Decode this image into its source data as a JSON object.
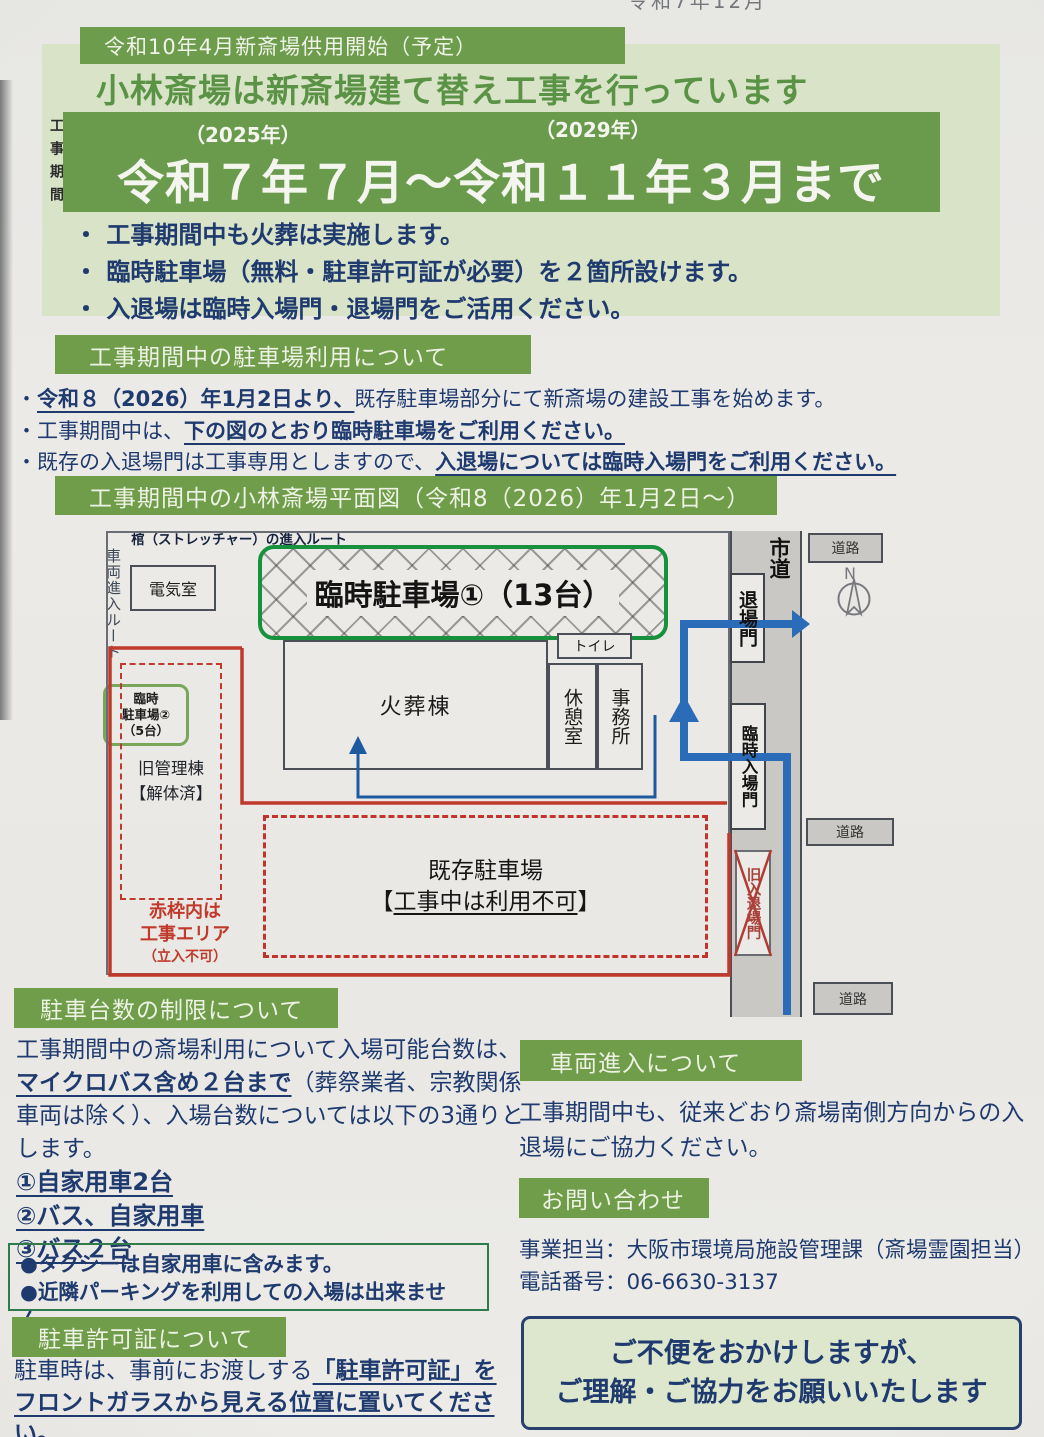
{
  "photo": {
    "top_cut_text": "令和7年12月"
  },
  "banner": {
    "pre_title": "令和10年4月新斎場供用開始（予定）",
    "title": "小林斎場は新斎場建て替え工事を行っています",
    "side_label": "工事期間",
    "year_start": "（2025年）",
    "year_end": "（2029年）",
    "period": "令和７年７月～令和１１年３月まで"
  },
  "intro_bullets": [
    "・ 工事期間中も火葬は実施します。",
    "・ 臨時駐車場（無料・駐車許可証が必要）を２箇所設けます。",
    "・ 入退場は臨時入場門・退場門をご活用ください。"
  ],
  "parking_use": {
    "heading": "工事期間中の駐車場利用について",
    "lines": [
      {
        "pre": "・",
        "bold": "令和８（2026）年1月2日より、",
        "rest": "既存駐車場部分にて新斎場の建設工事を始めます。"
      },
      {
        "pre": "・工事期間中は、",
        "bold": "下の図のとおり臨時駐車場をご利用ください。",
        "rest": ""
      },
      {
        "pre": "・既存の入退場門は工事専用としますので、",
        "bold": "入退場については臨時入場門をご利用ください。",
        "rest": ""
      }
    ]
  },
  "map": {
    "heading": "工事期間中の小林斎場平面図（令和8（2026）年1月2日～）",
    "labels": {
      "electrical_room": "電気室",
      "temp_parking1": "臨時駐車場①（13台）",
      "toilet": "トイレ",
      "crematory": "火葬棟",
      "rest_room": "休憩室",
      "office": "事務所",
      "stretcher_route": "棺（ストレッチャー）の進入ルート",
      "vehicle_route": "車両進入ルート",
      "exit_gate": "退場門",
      "temp_entrance_gate": "臨時入場門",
      "old_gate": "旧入退場門",
      "city_road": "市道",
      "road": "道路",
      "north": "N",
      "temp_parking2_line1": "臨時",
      "temp_parking2_line2": "駐車場②",
      "temp_parking2_line3": "（5台）",
      "old_admin_line1": "旧管理棟",
      "old_admin_line2": "【解体済】",
      "red_note_line1": "赤枠内は",
      "red_note_line2": "工事エリア",
      "red_note_line3": "（立入不可）",
      "existing_line1": "既存駐車場",
      "existing_line2_open": "【",
      "existing_line2_underlined": "工事中は利用不可",
      "existing_line2_close": "】"
    }
  },
  "limit": {
    "heading": "駐車台数の制限について",
    "body": {
      "seg1": "工事期間中の斎場利用について入場可能台数は、",
      "seg2_bold_underline": "マイクロバス含め２台まで",
      "seg3": "（葬祭業者、宗教関係車両は除く）、入場台数については以下の3通りとします。"
    },
    "items": [
      "①自家用車2台",
      "②バス、自家用車",
      "③バス２台"
    ],
    "notes": [
      "●タクシーは自家用車に含みます。",
      "●近隣パーキングを利用しての入場は出来ません。"
    ]
  },
  "permit": {
    "heading": "駐車許可証について",
    "body": {
      "seg1": "駐車時は、事前にお渡しする",
      "seg2_bold_underline": "「駐車許可証」をフロントガラスから見える位置に置いてください。"
    }
  },
  "entry": {
    "heading": "車両進入について",
    "body": "工事期間中も、従来どおり斎場南側方向からの入退場にご協力ください。"
  },
  "contact": {
    "heading": "お問い合わせ",
    "line1": "事業担当：大阪市環境局施設管理課（斎場霊園担当）",
    "line2": "電話番号：06-6630-3137"
  },
  "closing": {
    "line1": "ご不便をおかけしますが、",
    "line2": "ご理解・ご協力をお願いいたします"
  },
  "colors": {
    "header_green": "#6f9d4a",
    "band_green": "#6a9b4c",
    "panel_light_green": "#d9e3c7",
    "title_green": "#5a9346",
    "text_navy": "#1f3a6e",
    "construction_red": "#c0392b",
    "route_blue": "#2b6cb8",
    "parking1_border_green": "#18913f",
    "parking2_border_green": "#7aa65b",
    "road_gray": "#c9c8c4"
  }
}
